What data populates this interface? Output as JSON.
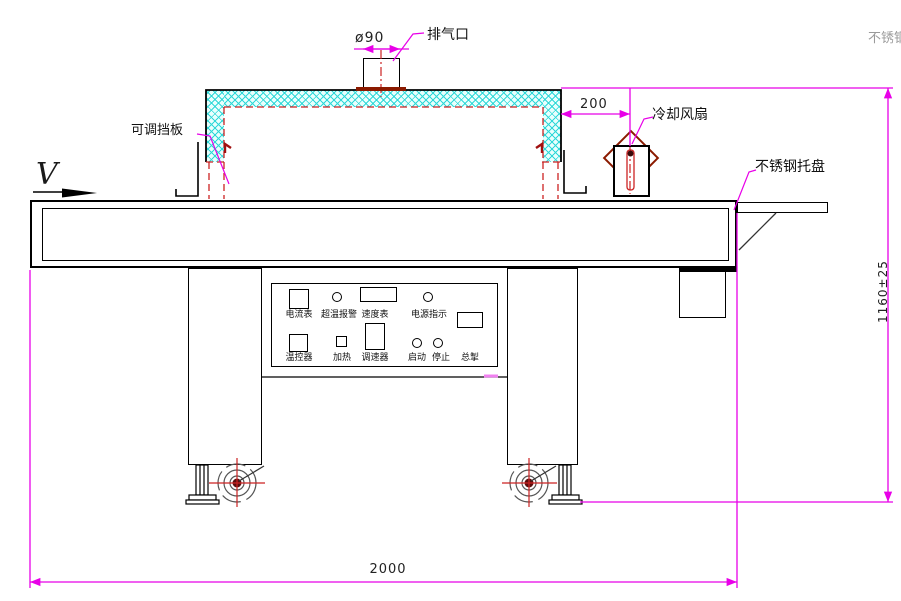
{
  "drawing": {
    "type": "engineering-diagram",
    "subject": "tunnel conveyor dryer side view"
  },
  "annotations": {
    "exhaust_port": "排气口",
    "diameter": "ø90",
    "offset_200": "200",
    "cooling_fan": "冷却风扇",
    "tray": "不锈钢托盘",
    "stainless_clipped": "不锈钢",
    "baffle": "可调挡板",
    "belt_speed_symbol": "V",
    "height_dim": "1160±25",
    "length_dim": "2000"
  },
  "control_panel": {
    "ammeter": "电流表",
    "overtemp_alarm": "超温报警",
    "speed_meter": "速度表",
    "power_indicator": "电源指示",
    "temp_controller": "温控器",
    "heating": "加热",
    "speed_regulator": "调速器",
    "start": "启动",
    "stop": "停止",
    "main_switch": "总掣"
  },
  "colors": {
    "dimension_line": "#e800e8",
    "red_dashed": "#cc2222",
    "dark_red": "#8b1a00",
    "hatch_cyan": "#2fd8d8",
    "outline": "#000000",
    "gray_text": "#9a9a9a"
  }
}
